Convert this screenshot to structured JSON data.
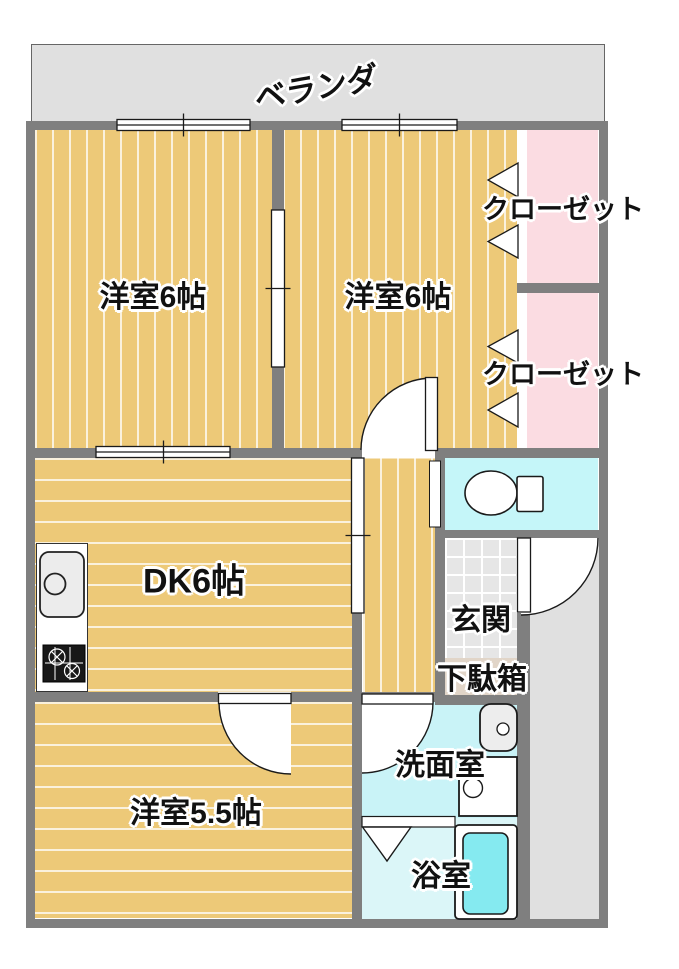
{
  "plan": {
    "veranda": {
      "label": "ベランダ"
    },
    "bedroom1": {
      "label": "洋室6帖"
    },
    "bedroom2": {
      "label": "洋室6帖"
    },
    "closet1": {
      "label": "クローゼット"
    },
    "closet2": {
      "label": "クローゼット"
    },
    "dk": {
      "label": "DK6帖"
    },
    "bedroom3": {
      "label": "洋室5.5帖"
    },
    "genkan": {
      "label": "玄関"
    },
    "getabako": {
      "label": "下駄箱"
    },
    "washroom": {
      "label": "洗面室"
    },
    "bathroom": {
      "label": "浴室"
    }
  },
  "colors": {
    "wall": "#7f7f7f",
    "wood_floor": "#edc978",
    "veranda": "#e0e0e0",
    "closet_pink": "#fbdce2",
    "toilet_room_cyan": "#c5f6f9",
    "washroom_cyan": "#c9f3f7",
    "bathroom_cyan": "#dbf6f8",
    "bathtub_cyan": "#85eaf0",
    "genkan_tile": "#e6e6e6",
    "shoe_cabinet_beige": "#e1d5c8",
    "exterior_walkway": "#e0e0e0"
  }
}
